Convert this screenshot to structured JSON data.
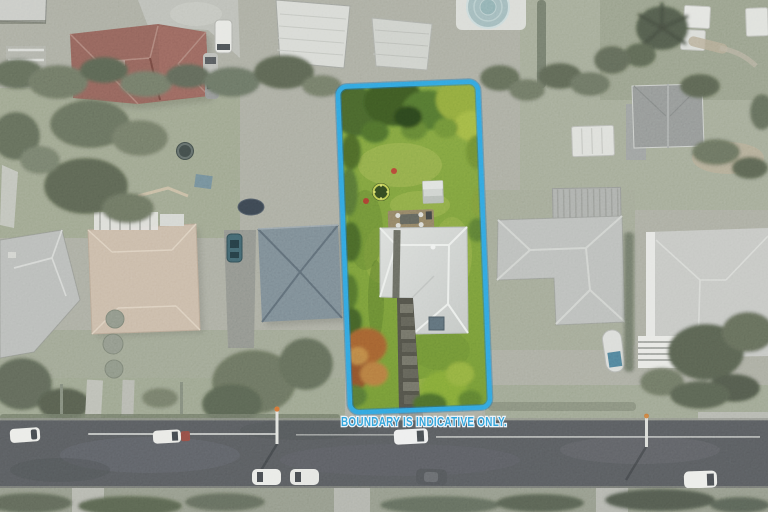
{
  "image": {
    "kind": "aerial-drone-photo",
    "effect": "surroundings desaturated; subject lot shown in full colour"
  },
  "overlay": {
    "label": "BOUNDARY IS INDICATIVE ONLY.",
    "boundary_color": "#2f9fdd",
    "boundary_edge_color": "#1d6fae",
    "label_fill": "#2e9ad6",
    "label_halo": "#e8f2fa"
  },
  "scene": {
    "subject_lot_features": [
      "lawn",
      "mature trees",
      "trampoline",
      "garden shed",
      "timber patio",
      "L-shaped light-grey roofed house",
      "stone path to street",
      "rust-coloured tree",
      "green shrubs"
    ],
    "surrounding_features": [
      "red tiled roof house",
      "tan roofed house with pergola",
      "grey hip-roofed houses",
      "blue-grey pyramid roof house",
      "above-ground swimming pool",
      "white garden sheds",
      "boat with blue cover",
      "two trampolines",
      "street with parked cars",
      "crossing poles",
      "hedges, palms and trees"
    ],
    "road": {
      "position": "bottom",
      "orientation": "horizontal",
      "parked_cars_white": 6,
      "parked_cars_dark": 1
    }
  }
}
